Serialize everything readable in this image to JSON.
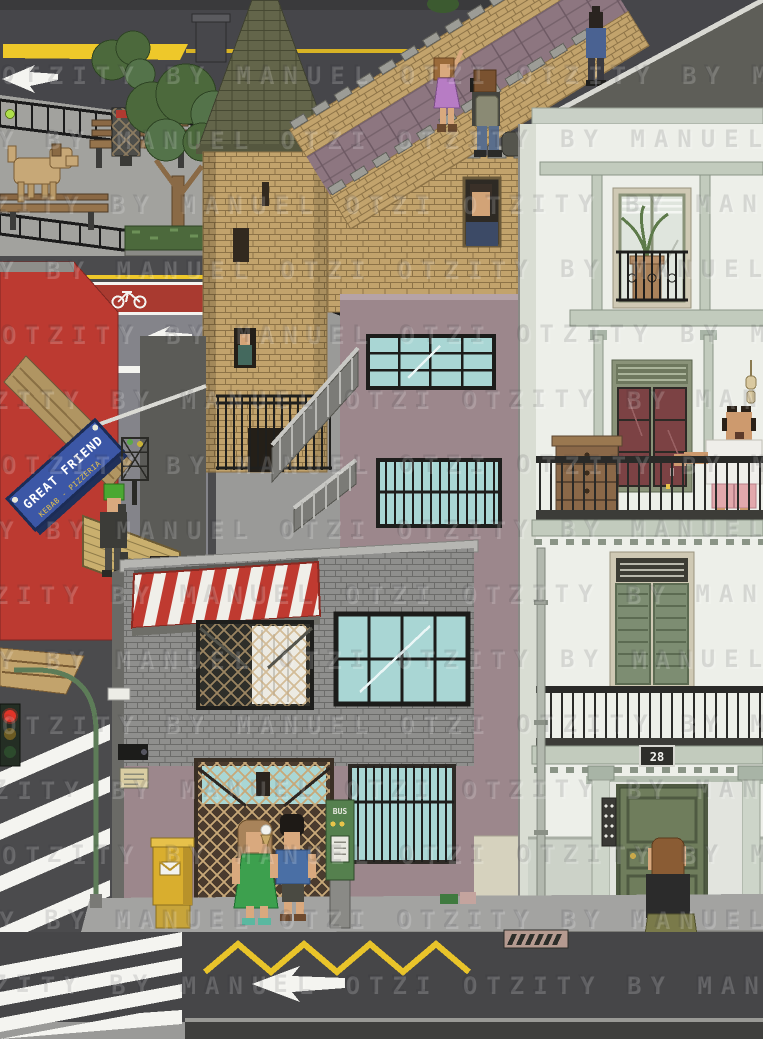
{
  "artwork": {
    "type": "isometric pixel-art city street scene",
    "watermark_text": "OTZITY BY MANUEL OTZI",
    "watermark_row": "OTZITY BY MANUEL OTZI  OTZITY BY MANUEL OTZI  OTZITY BY MANUEL OTZI"
  },
  "texts": {
    "shop_sign_line1": "GREAT FRIEND",
    "shop_sign_line2": "KEBAB - PIZZERIA",
    "house_number": "28",
    "bus_machine_label": "BUS"
  },
  "palette": {
    "road": "#4b4b4d",
    "sidewalk": "#a3a3a1",
    "marking_yellow": "#eec82a",
    "marking_white": "#f4f4f0",
    "bike_lane_red": "#a93a30",
    "brick_tan": "#c2a36c",
    "roof_olive": "#63654a",
    "walkway_mauve": "#8d7680",
    "mauve_wall": "#9c878c",
    "shop_brick_gray": "#8f8f8d",
    "awning_red": "#bf3a30",
    "awning_white": "#f0efe9",
    "window_glass_blue": "#a9d6d4",
    "red_building": "#bc3a31",
    "shutter_tan": "#c9af6e",
    "sign_blue": "#3c57a6",
    "sign_text_yellow": "#e8c44a",
    "apartment_white": "#edefe9",
    "trim_sage": "#c2cbbd",
    "door_green": "#6f7d5c",
    "curtain_red": "#7c4244",
    "postbox_yellow": "#d9ae2e",
    "bus_machine_green": "#55804e",
    "traffic_light_red": "#e03428",
    "tree_green": "#4c693c",
    "dog_tan": "#c7a877",
    "dress_green": "#3da04e",
    "dress_purple": "#b77cc4",
    "shorts_pink": "#e2a8ac"
  },
  "scene": {
    "buildings": [
      "red kebab-pizzeria shop with tan roller shutter",
      "round castle tower with olive conical roof",
      "crenellated city wall with tiled walkway",
      "mauve warehouse with pale blue industrial windows",
      "gray brick shop with red-and-white striped awning",
      "white apartment house number 28 with balconies"
    ],
    "people": [
      "woman in purple dress posing on the wall walkway",
      "photographer with backpack taking her picture",
      "person walking away along the walkway",
      "man looking out of a window in the city wall",
      "person at a window inside the tower",
      "green-haired person standing by the kebab shop",
      "balding man in white t-shirt and pink shorts smoking on a balcony",
      "woman in green dress eating an ice cream",
      "man in blue t-shirt standing beside her",
      "woman with long brown hair at the entrance door"
    ],
    "objects": [
      "running dog and tennis ball in the park",
      "park benches and street tree",
      "litter bins",
      "yellow postbox",
      "green bus ticket machine",
      "traffic light showing red",
      "zebra crossings",
      "red bike lane with bicycle marking",
      "white road arrows",
      "yellow zigzag road marking",
      "storm drain grate",
      "security camera and small notice sign"
    ]
  }
}
